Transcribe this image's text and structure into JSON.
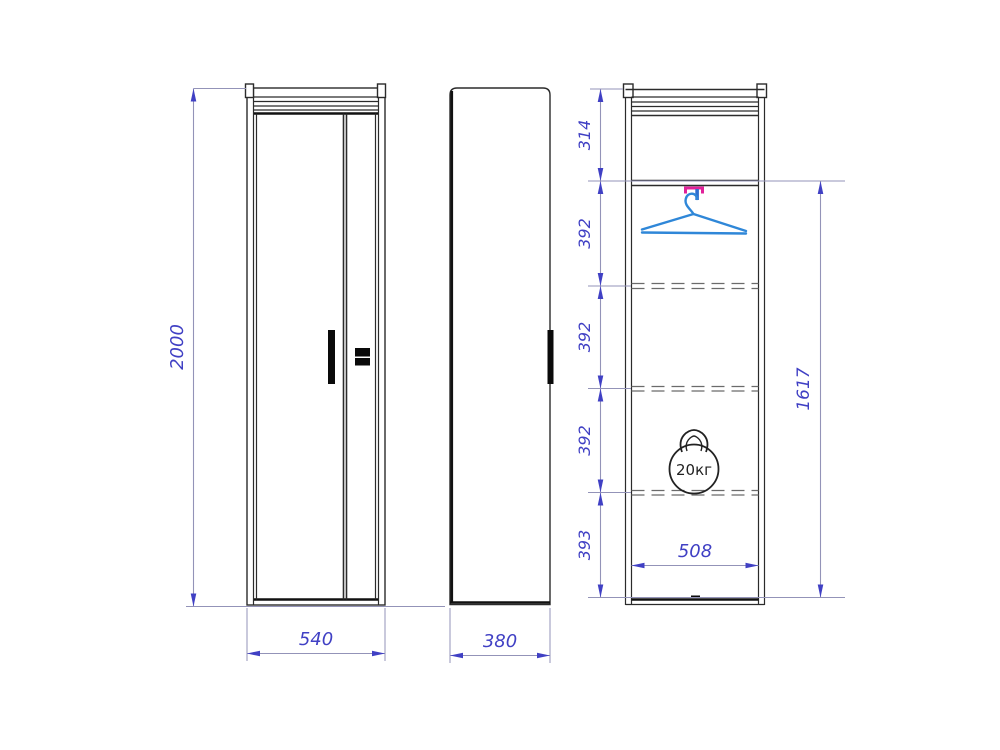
{
  "drawing_type": "wardrobe-three-view-dimension-drawing",
  "front_view": {
    "height": "2000",
    "width": "540"
  },
  "side_view": {
    "depth": "380"
  },
  "section_view": {
    "segments": [
      "314",
      "392",
      "392",
      "392",
      "393"
    ],
    "interior_height": "1617",
    "interior_width": "508",
    "max_load": "20кг"
  },
  "colors": {
    "outline": "#2b2b2b",
    "dimension": "#4040c4",
    "extension": "#9393b8",
    "hanger": "#2f87d8",
    "bracket": "#e0219a"
  }
}
